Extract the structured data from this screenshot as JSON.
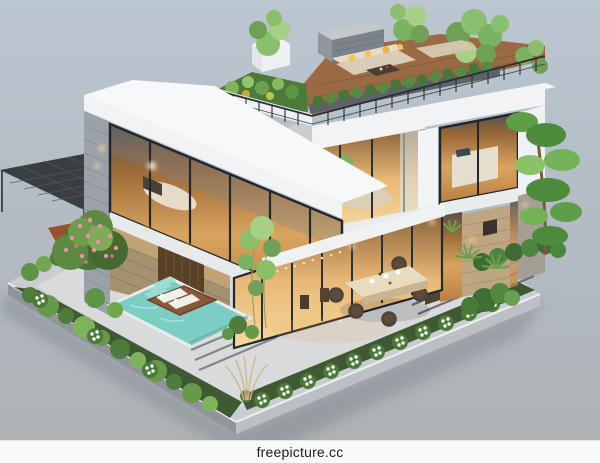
{
  "image": {
    "type": "3d-architectural-render",
    "description": "Isometric 3D rendering of a modern two-story villa with a rooftop terrace garden and lounge, full-height warm-lit glass facades, stone accent walls, a turquoise swimming pool with a wooden lounger platform, a dark slatted pergola carport, landscaped garden beds with white flowers and a pink flowering shrub, an outdoor dining set on a stone patio, and a tall sculpted pine tree, all on a rectangular plot over a plain gray studio backdrop."
  },
  "watermark": {
    "text": "freepicture.cc"
  },
  "palette": {
    "backdrop_top": "#bbc6d0",
    "backdrop_bottom": "#aeb2b6",
    "plot_surface": "#d8dadb",
    "plot_wall_left": "#8f959b",
    "plot_wall_right": "#bcc0c4",
    "roof_white": "#f1f3f5",
    "fascia_shade": "#dde1e4",
    "glass_frame": "#23282e",
    "window_warm": "#b97f42",
    "stone_gray": "#9aa1a9",
    "stone_tan": "#bfa682",
    "deck_wood": "#9a6a44",
    "corten_planter": "#9c4f2b",
    "pool_water": "#7ccdc3",
    "pool_coping": "#e9ebe9",
    "lounger_white": "#f0efe9",
    "foliage_dark": "#3f6f33",
    "foliage_mid": "#5f9447",
    "foliage_light": "#8abf6d",
    "flower_pink": "#ea93a8",
    "flower_white": "#ffffff",
    "sofa_beige": "#d9cdb6",
    "pillow_yellow": "#f2c45e",
    "railing_dark": "#2a2e33",
    "paver_strip": "#5a6167",
    "sconce_glow": "#ffd9a0",
    "table_wood": "#e8dcc0",
    "chair_rattan": "#4e4337",
    "watermark_bar": "#f8f9f9",
    "watermark_text": "#1b1b1b"
  },
  "scene": {
    "elements": [
      "modern villa",
      "rooftop terrace garden",
      "terrace lounge sofa with yellow pillows",
      "upper-floor bedroom glass wall",
      "balcony living room",
      "right-wing bedroom window",
      "swimming pool",
      "in-pool lounger platform",
      "pergola carport",
      "corten planter wall",
      "pink flowering shrub",
      "garden beds",
      "white flower border",
      "boxwood hedges",
      "agave plants",
      "sculpted pine tree",
      "outdoor dining table with rattan chairs",
      "stone paver walkway with dark inlay strips",
      "stepping stones",
      "wall sconce lights"
    ]
  }
}
